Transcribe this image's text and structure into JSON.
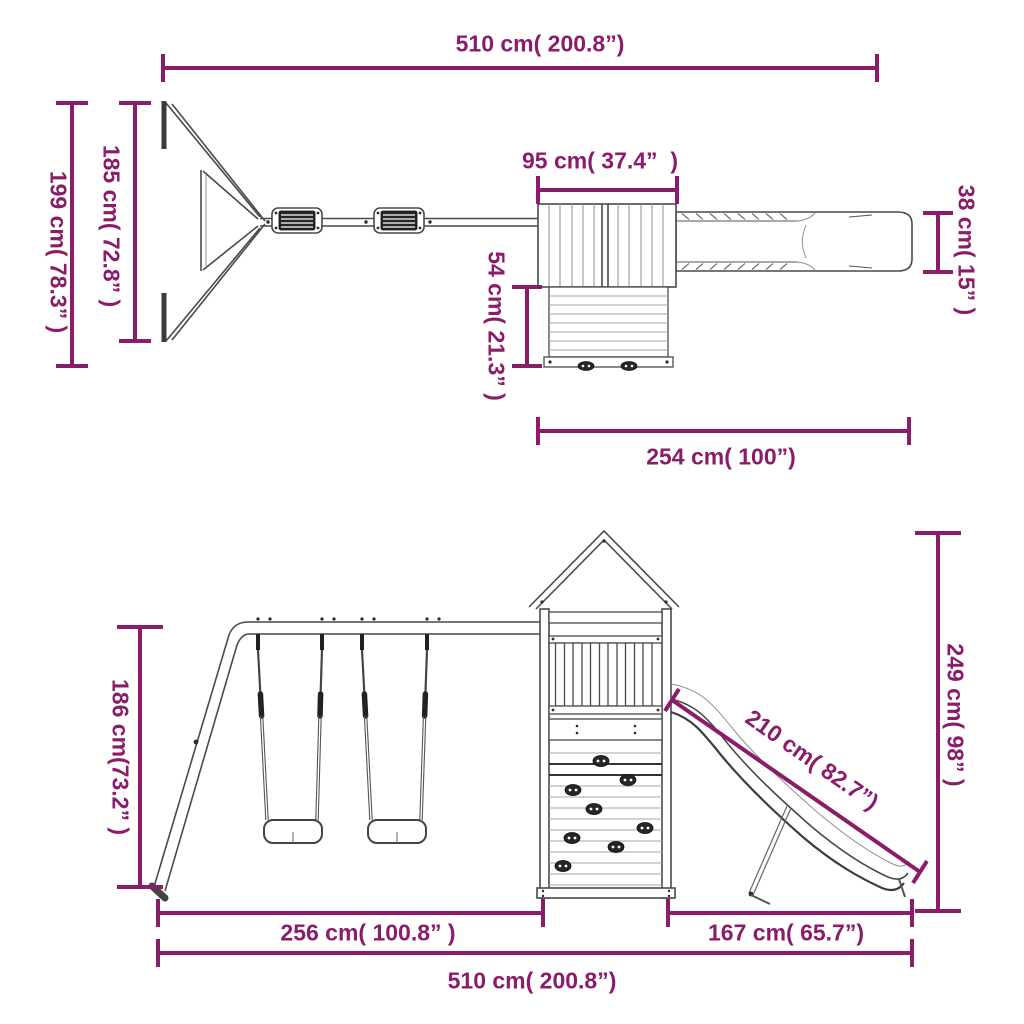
{
  "title": "Playset dimension diagram",
  "accent_color": "#8a1c6a",
  "structure_line_color": "#4a4a4a",
  "top_view": {
    "dims": {
      "overall_width": "510 cm( 200.8”)",
      "frame_depth_overall": "199 cm( 78.3” )",
      "frame_depth_inner": "185 cm( 72.8” )",
      "roof_width": "95 cm( 37.4”  )",
      "tower_depth": "54 cm( 21.3” )",
      "slide_width": "38 cm( 15” )",
      "tower_slide_length": "254 cm( 100”)"
    }
  },
  "front_view": {
    "dims": {
      "tower_height": "249 cm( 98” )",
      "slide_length": "210 cm( 82.7”)",
      "swing_frame_height": "186 cm(73.2” )",
      "swing_section_width": "256 cm( 100.8” )",
      "slide_run_length": "167 cm( 65.7”)",
      "overall_width": "510 cm( 200.8”)"
    }
  }
}
